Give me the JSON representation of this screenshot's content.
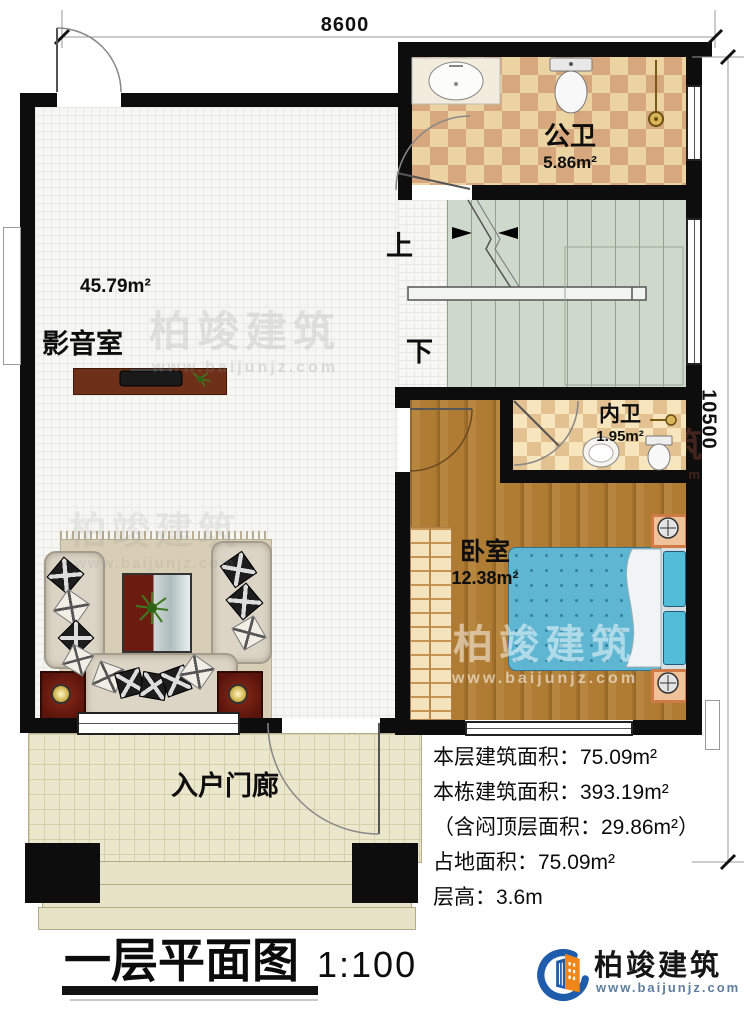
{
  "plan": {
    "dimensions": {
      "width_label": "8600",
      "height_label": "10500"
    },
    "rooms": {
      "public_bath": {
        "name": "公卫",
        "area": "5.86m²"
      },
      "media_room": {
        "name": "影音室",
        "area": "45.79m²"
      },
      "inner_bath": {
        "name": "内卫",
        "area": "1.95m²"
      },
      "bedroom": {
        "name": "卧室",
        "area": "12.38m²"
      },
      "porch": {
        "name": "入户门廊"
      }
    },
    "stairs": {
      "up_label": "上",
      "down_label": "下"
    }
  },
  "info_panel": {
    "lines": [
      "本层建筑面积：75.09m²",
      "本栋建筑面积：393.19m²",
      "（含闷顶层面积：29.86m²）",
      "占地面积：75.09m²",
      "层高：3.6m"
    ]
  },
  "title_block": {
    "title": "一层平面图",
    "scale": "1:100"
  },
  "brand": {
    "name": "柏竣建筑",
    "website": "www.baijunjz.com"
  },
  "watermark": {
    "name": "柏竣建筑",
    "website": "www.baijunjz.com"
  },
  "colors": {
    "brand_blue": "#1f5cab",
    "brand_orange": "#f08519",
    "wall": "#0d0d0d"
  }
}
